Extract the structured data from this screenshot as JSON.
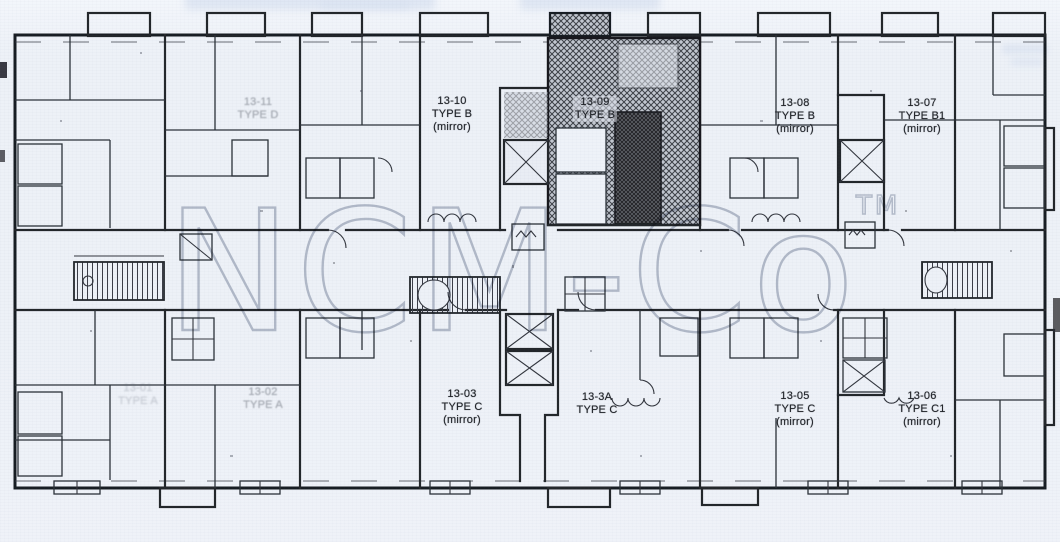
{
  "watermark": {
    "text": "NCM-Co",
    "tm_mark": "TM",
    "color": "#b3b9c6"
  },
  "units": {
    "u13_11": {
      "id": "13-11",
      "type": "TYPE D",
      "mirror": ""
    },
    "u13_10": {
      "id": "13-10",
      "type": "TYPE B",
      "mirror": "(mirror)"
    },
    "u13_09": {
      "id": "13-09",
      "type": "TYPE B",
      "mirror": ""
    },
    "u13_08": {
      "id": "13-08",
      "type": "TYPE B",
      "mirror": "(mirror)"
    },
    "u13_07": {
      "id": "13-07",
      "type": "TYPE B1",
      "mirror": "(mirror)"
    },
    "u13_01": {
      "id": "13-01",
      "type": "TYPE A",
      "mirror": ""
    },
    "u13_02": {
      "id": "13-02",
      "type": "TYPE A",
      "mirror": ""
    },
    "u13_03": {
      "id": "13-03",
      "type": "TYPE C",
      "mirror": "(mirror)"
    },
    "u13_3A": {
      "id": "13-3A",
      "type": "TYPE C",
      "mirror": ""
    },
    "u13_05": {
      "id": "13-05",
      "type": "TYPE C",
      "mirror": "(mirror)"
    },
    "u13_06": {
      "id": "13-06",
      "type": "TYPE C1",
      "mirror": "(mirror)"
    }
  }
}
